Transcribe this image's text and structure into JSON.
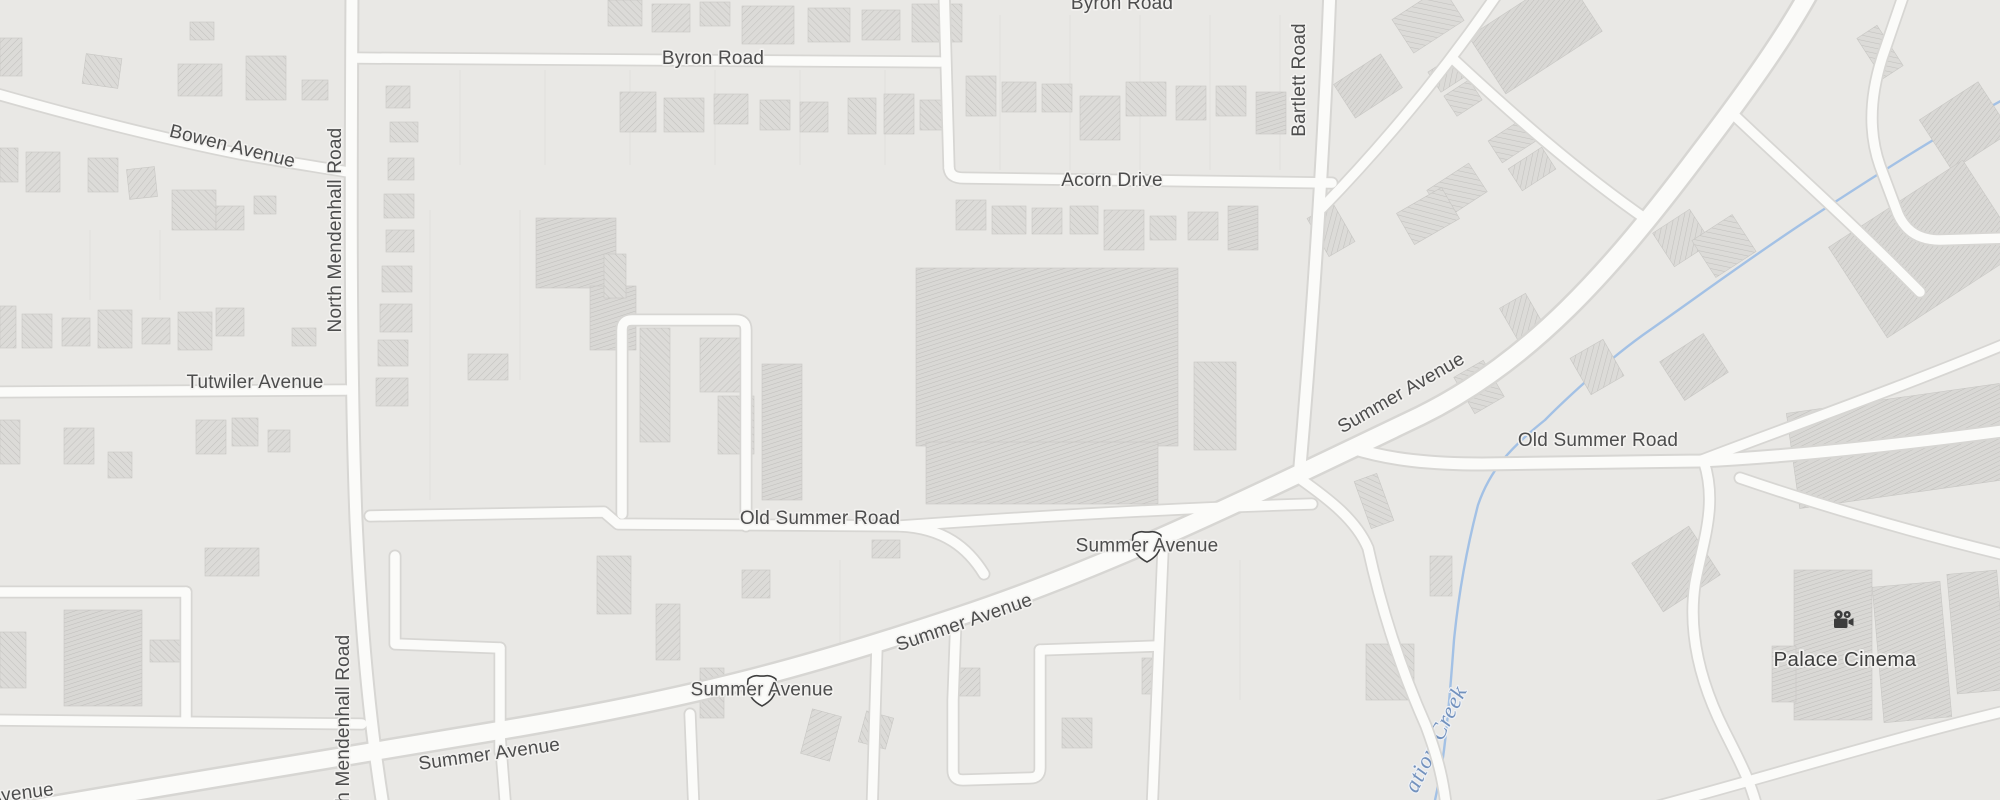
{
  "map": {
    "colors": {
      "background": "#e9e8e5",
      "road_fill": "#fbfbf9",
      "road_casing": "#d7d6d3",
      "building_fill": "#dcdbd8",
      "building_hatch": "#c2c1be",
      "creek": "#a3c1e5",
      "label": "#4d4d4d",
      "creek_label": "#7291bd",
      "poi_label": "#3e3e3e"
    },
    "roads": [
      {
        "id": "summer-avenue",
        "w": "major",
        "d": "M -20 818 C 160 786 330 760 520 727 C 700 696 810 666 960 616 C 1110 566 1240 502 1420 416 C 1530 362 1610 272 1700 152 C 1755 80 1795 22 1820 -28"
      },
      {
        "id": "north-mendenhall-road",
        "w": "mid",
        "d": "M 352 -10 C 351 180 350 360 356 520 C 362 650 372 740 384 812"
      },
      {
        "id": "bowen-avenue",
        "w": "minor",
        "d": "M -10 92 C 60 112 150 136 240 154 C 290 163 326 168 348 172"
      },
      {
        "id": "tutwiler-avenue",
        "w": "minor",
        "d": "M -10 392 L 346 390"
      },
      {
        "id": "byron-road-west",
        "w": "minor",
        "d": "M 354 58 L 940 62"
      },
      {
        "id": "byron-connector",
        "w": "minor",
        "d": "M 944 -12 L 949 168"
      },
      {
        "id": "acorn-drive",
        "w": "minor",
        "d": "M 949 168 C 950 176 956 178 964 178 L 1332 183"
      },
      {
        "id": "bartlett-road",
        "w": "mid",
        "d": "M 1330 -12 C 1324 150 1312 330 1299 478"
      },
      {
        "id": "old-summer-road-west",
        "w": "minor",
        "d": "M 370 516 L 604 512 L 618 524 L 900 526 C 944 528 968 548 984 574"
      },
      {
        "id": "old-summer-road-west-branch",
        "w": "minor",
        "d": "M 900 526 C 1040 516 1180 508 1312 504"
      },
      {
        "id": "mid-loop",
        "w": "minor",
        "d": "M 622 514 L 622 330 Q 622 320 632 320 L 736 320 Q 746 320 746 330 L 746 526"
      },
      {
        "id": "stub-a",
        "w": "minor",
        "d": "M 395 556 L 395 644 L 500 648"
      },
      {
        "id": "stub-b",
        "w": "minor",
        "d": "M 500 648 L 500 752"
      },
      {
        "id": "left-block-north",
        "w": "minor",
        "d": "M -10 592 L 186 592"
      },
      {
        "id": "left-block-east",
        "w": "minor",
        "d": "M 186 592 L 186 720"
      },
      {
        "id": "left-block-south",
        "w": "minor",
        "d": "M -10 720 L 362 724"
      },
      {
        "id": "south-stub-1",
        "w": "minor",
        "d": "M 500 736 L 506 812"
      },
      {
        "id": "south-stub-2",
        "w": "minor",
        "d": "M 690 714 L 694 812"
      },
      {
        "id": "south-road-1",
        "w": "minor",
        "d": "M 877 646 L 872 812"
      },
      {
        "id": "se-loop",
        "w": "minor",
        "d": "M 956 618 L 953 700 L 953 770 Q 953 780 963 780 L 1030 778 Q 1040 778 1040 768 L 1040 650"
      },
      {
        "id": "se-connector",
        "w": "minor",
        "d": "M 1040 650 L 1158 646"
      },
      {
        "id": "south-road-2",
        "w": "minor",
        "d": "M 1163 550 C 1160 620 1157 700 1152 812"
      },
      {
        "id": "creekside-road",
        "w": "minor",
        "d": "M 1299 478 C 1330 500 1356 520 1368 548 C 1382 612 1402 672 1426 726 C 1438 758 1444 782 1447 814"
      },
      {
        "id": "old-summer-road-east",
        "w": "mid",
        "d": "M 1352 448 C 1390 460 1432 464 1482 464 L 1700 461 C 1800 456 1920 442 2010 430"
      },
      {
        "id": "fork-up",
        "w": "minor",
        "d": "M 1702 460 C 1780 430 1900 388 2010 342"
      },
      {
        "id": "cinema-road",
        "w": "minor",
        "d": "M 1704 462 C 1718 506 1702 544 1695 584 C 1688 632 1700 682 1724 730 C 1740 762 1752 784 1758 812"
      },
      {
        "id": "bottom-diagonal",
        "w": "minor",
        "d": "M 1636 812 C 1750 782 1900 736 2010 710"
      },
      {
        "id": "lower-branch",
        "w": "minor",
        "d": "M 1740 478 C 1810 502 1910 532 2010 556"
      },
      {
        "id": "ne-street-1",
        "w": "minor",
        "d": "M 1322 208 C 1380 148 1440 78 1500 -10"
      },
      {
        "id": "ne-street-2",
        "w": "minor",
        "d": "M 1452 58 C 1510 112 1575 170 1650 222"
      },
      {
        "id": "ne-street-3",
        "w": "minor",
        "d": "M 1735 116 C 1792 170 1855 226 1920 292"
      },
      {
        "id": "ne-loop",
        "w": "minor",
        "d": "M 1906 -12 L 1882 58 C 1870 96 1868 132 1880 166 L 1898 214 C 1906 232 1920 240 1940 240 L 2010 238"
      }
    ],
    "buildings": [
      [
        0,
        38,
        22,
        38,
        0,
        0
      ],
      [
        84,
        56,
        36,
        30,
        8,
        1
      ],
      [
        178,
        64,
        44,
        32,
        0,
        0
      ],
      [
        246,
        56,
        40,
        44,
        0,
        1
      ],
      [
        302,
        80,
        26,
        20,
        0,
        0
      ],
      [
        190,
        22,
        24,
        18,
        0,
        1
      ],
      [
        0,
        148,
        18,
        34,
        0,
        1
      ],
      [
        26,
        152,
        34,
        40,
        0,
        0
      ],
      [
        88,
        158,
        30,
        34,
        0,
        1
      ],
      [
        128,
        168,
        28,
        30,
        -6,
        0
      ],
      [
        172,
        190,
        44,
        40,
        0,
        1
      ],
      [
        216,
        206,
        28,
        24,
        0,
        0
      ],
      [
        254,
        196,
        22,
        18,
        0,
        1
      ],
      [
        0,
        306,
        16,
        42,
        0,
        0
      ],
      [
        22,
        314,
        30,
        34,
        0,
        1
      ],
      [
        62,
        318,
        28,
        28,
        0,
        0
      ],
      [
        98,
        310,
        34,
        38,
        0,
        1
      ],
      [
        142,
        318,
        28,
        26,
        0,
        0
      ],
      [
        178,
        312,
        34,
        38,
        0,
        1
      ],
      [
        216,
        308,
        28,
        28,
        0,
        0
      ],
      [
        292,
        328,
        24,
        18,
        0,
        1
      ],
      [
        0,
        420,
        20,
        44,
        0,
        1
      ],
      [
        64,
        428,
        30,
        36,
        0,
        0
      ],
      [
        108,
        452,
        24,
        26,
        0,
        1
      ],
      [
        196,
        420,
        30,
        34,
        0,
        0
      ],
      [
        232,
        418,
        26,
        28,
        0,
        1
      ],
      [
        268,
        430,
        22,
        22,
        0,
        0
      ],
      [
        64,
        610,
        78,
        96,
        0,
        2
      ],
      [
        0,
        632,
        26,
        56,
        0,
        1
      ],
      [
        205,
        548,
        54,
        28,
        0,
        0
      ],
      [
        150,
        640,
        30,
        22,
        0,
        1
      ],
      [
        386,
        86,
        24,
        22,
        0,
        0
      ],
      [
        390,
        122,
        28,
        20,
        0,
        1
      ],
      [
        388,
        158,
        26,
        22,
        0,
        0
      ],
      [
        384,
        194,
        30,
        24,
        0,
        1
      ],
      [
        386,
        230,
        28,
        22,
        0,
        0
      ],
      [
        382,
        266,
        30,
        26,
        0,
        1
      ],
      [
        380,
        304,
        32,
        28,
        0,
        0
      ],
      [
        378,
        340,
        30,
        26,
        0,
        1
      ],
      [
        376,
        378,
        32,
        28,
        0,
        0
      ],
      [
        608,
        0,
        34,
        26,
        0,
        1
      ],
      [
        652,
        4,
        38,
        28,
        0,
        0
      ],
      [
        700,
        2,
        30,
        24,
        0,
        1
      ],
      [
        742,
        6,
        52,
        38,
        0,
        0
      ],
      [
        808,
        8,
        42,
        34,
        0,
        1
      ],
      [
        862,
        10,
        38,
        30,
        0,
        0
      ],
      [
        912,
        4,
        50,
        38,
        0,
        1
      ],
      [
        620,
        92,
        36,
        40,
        0,
        0
      ],
      [
        664,
        98,
        40,
        34,
        0,
        1
      ],
      [
        714,
        94,
        34,
        30,
        0,
        0
      ],
      [
        760,
        100,
        30,
        30,
        0,
        1
      ],
      [
        800,
        102,
        28,
        30,
        0,
        0
      ],
      [
        848,
        98,
        28,
        36,
        0,
        1
      ],
      [
        884,
        94,
        30,
        40,
        0,
        0
      ],
      [
        920,
        100,
        24,
        30,
        0,
        1
      ],
      [
        966,
        76,
        30,
        40,
        0,
        1
      ],
      [
        1002,
        82,
        34,
        30,
        0,
        0
      ],
      [
        1042,
        84,
        30,
        28,
        0,
        1
      ],
      [
        1080,
        96,
        40,
        44,
        0,
        0
      ],
      [
        1126,
        82,
        40,
        34,
        0,
        1
      ],
      [
        1176,
        86,
        30,
        34,
        0,
        0
      ],
      [
        1216,
        86,
        30,
        30,
        0,
        1
      ],
      [
        1256,
        92,
        30,
        42,
        0,
        2
      ],
      [
        956,
        200,
        30,
        30,
        0,
        0
      ],
      [
        992,
        206,
        34,
        28,
        0,
        1
      ],
      [
        1032,
        208,
        30,
        26,
        0,
        0
      ],
      [
        1070,
        206,
        28,
        28,
        0,
        1
      ],
      [
        1104,
        210,
        40,
        40,
        0,
        0
      ],
      [
        1150,
        216,
        26,
        24,
        0,
        1
      ],
      [
        1188,
        212,
        30,
        28,
        0,
        0
      ],
      [
        1228,
        206,
        30,
        44,
        0,
        2
      ],
      [
        536,
        218,
        80,
        70,
        0,
        2
      ],
      [
        590,
        286,
        46,
        64,
        0,
        2
      ],
      [
        640,
        328,
        30,
        114,
        0,
        1
      ],
      [
        700,
        338,
        42,
        54,
        0,
        0
      ],
      [
        718,
        396,
        36,
        58,
        0,
        1
      ],
      [
        468,
        354,
        40,
        26,
        0,
        0
      ],
      [
        604,
        254,
        22,
        44,
        0,
        1
      ],
      [
        916,
        268,
        262,
        178,
        0,
        2
      ],
      [
        926,
        442,
        232,
        62,
        0,
        2
      ],
      [
        1194,
        362,
        42,
        88,
        0,
        1
      ],
      [
        762,
        364,
        40,
        136,
        0,
        2
      ],
      [
        872,
        540,
        28,
        18,
        0,
        0
      ],
      [
        597,
        556,
        34,
        58,
        0,
        1
      ],
      [
        656,
        604,
        24,
        56,
        0,
        0
      ],
      [
        700,
        668,
        24,
        50,
        0,
        1
      ],
      [
        742,
        570,
        28,
        28,
        0,
        0
      ],
      [
        862,
        714,
        28,
        32,
        15,
        1
      ],
      [
        952,
        668,
        28,
        28,
        0,
        0
      ],
      [
        1062,
        718,
        30,
        30,
        0,
        1
      ],
      [
        1142,
        658,
        20,
        36,
        0,
        0
      ],
      [
        1340,
        66,
        56,
        40,
        -33,
        2
      ],
      [
        1398,
        0,
        60,
        40,
        -33,
        1
      ],
      [
        1432,
        62,
        30,
        24,
        -33,
        0
      ],
      [
        1448,
        86,
        30,
        24,
        -33,
        1
      ],
      [
        1478,
        0,
        115,
        68,
        -33,
        2
      ],
      [
        1492,
        128,
        40,
        26,
        -33,
        1
      ],
      [
        1512,
        156,
        40,
        26,
        -33,
        0
      ],
      [
        1432,
        174,
        50,
        34,
        -33,
        1
      ],
      [
        1660,
        218,
        44,
        40,
        -33,
        0
      ],
      [
        1868,
        28,
        24,
        48,
        -33,
        1
      ],
      [
        1930,
        96,
        70,
        60,
        -33,
        2
      ],
      [
        1845,
        195,
        160,
        108,
        -33,
        2
      ],
      [
        1700,
        224,
        48,
        44,
        -33,
        1
      ],
      [
        1316,
        208,
        30,
        44,
        -30,
        0
      ],
      [
        1402,
        198,
        52,
        36,
        -30,
        1
      ],
      [
        1508,
        298,
        30,
        42,
        -30,
        0
      ],
      [
        1462,
        366,
        34,
        42,
        -30,
        1
      ],
      [
        1578,
        346,
        38,
        42,
        -30,
        0
      ],
      [
        1668,
        344,
        52,
        46,
        -33,
        2
      ],
      [
        1792,
        398,
        215,
        96,
        -8,
        2
      ],
      [
        1642,
        540,
        68,
        58,
        -33,
        2
      ],
      [
        1362,
        476,
        24,
        50,
        -20,
        1
      ],
      [
        1430,
        556,
        22,
        40,
        0,
        0
      ],
      [
        1366,
        644,
        48,
        56,
        0,
        1
      ],
      [
        1794,
        570,
        78,
        150,
        0,
        2
      ],
      [
        1772,
        646,
        24,
        56,
        0,
        2
      ],
      [
        1878,
        584,
        68,
        136,
        -5,
        2
      ],
      [
        1952,
        572,
        50,
        120,
        -5,
        2
      ],
      [
        806,
        712,
        30,
        46,
        15,
        0
      ]
    ],
    "parcel_lines": [
      [
        460,
        70,
        165
      ],
      [
        545,
        70,
        165
      ],
      [
        630,
        70,
        165
      ],
      [
        715,
        70,
        165
      ],
      [
        800,
        70,
        165
      ],
      [
        885,
        70,
        165
      ],
      [
        1000,
        15,
        170
      ],
      [
        1070,
        15,
        170
      ],
      [
        1140,
        15,
        170
      ],
      [
        1210,
        15,
        170
      ],
      [
        1280,
        15,
        170
      ],
      [
        430,
        210,
        500
      ],
      [
        520,
        210,
        380
      ],
      [
        840,
        560,
        660
      ],
      [
        1240,
        560,
        700
      ],
      [
        90,
        230,
        300
      ],
      [
        160,
        230,
        300
      ]
    ],
    "labels": [
      {
        "text": "Byron Road",
        "x": 1122,
        "y": 9,
        "rot": 0
      },
      {
        "text": "Byron Road",
        "x": 713,
        "y": 64,
        "rot": 0
      },
      {
        "text": "Bowen Avenue",
        "x": 231,
        "y": 152,
        "rot": 14
      },
      {
        "text": "Acorn Drive",
        "x": 1112,
        "y": 186,
        "rot": 0
      },
      {
        "text": "Bartlett Road",
        "x": 1305,
        "y": 80,
        "rot": -90
      },
      {
        "text": "North Mendenhall Road",
        "x": 341,
        "y": 230,
        "rot": -90
      },
      {
        "text": "Tutwiler Avenue",
        "x": 255,
        "y": 388,
        "rot": 0
      },
      {
        "text": "Old Summer Road",
        "x": 820,
        "y": 524,
        "rot": 0
      },
      {
        "text": "Old Summer Road",
        "x": 1598,
        "y": 446,
        "rot": 0
      },
      {
        "text": "Summer Avenue",
        "x": 1404,
        "y": 398,
        "rot": -30
      },
      {
        "text": "Summer Avenue",
        "x": 966,
        "y": 628,
        "rot": -19
      },
      {
        "text": "Summer Avenue",
        "x": 490,
        "y": 760,
        "rot": -8
      },
      {
        "text": "North Mendenhall Road",
        "x": 349,
        "y": 737,
        "rot": -90
      },
      {
        "text": "Avenue",
        "x": 22,
        "y": 799,
        "rot": -7
      }
    ],
    "shields": [
      {
        "text": "Summer Avenue",
        "x": 1147,
        "y": 545,
        "icon": "us-route-shield-icon"
      },
      {
        "text": "Summer Avenue",
        "x": 762,
        "y": 689,
        "icon": "us-route-shield-icon"
      }
    ],
    "creek": {
      "d": "M 2010 96 C 1950 128 1880 172 1800 225 C 1740 265 1700 295 1650 330 C 1598 366 1545 420 1545 420 C 1510 448 1490 470 1478 505 C 1465 555 1458 600 1454 640 C 1451 680 1449 710 1444 750 C 1440 780 1436 795 1432 814",
      "label": {
        "text": "ation Creek",
        "x": 1442,
        "y": 742,
        "rot": -64
      }
    },
    "poi": {
      "label": "Palace Cinema",
      "icon": "cinema-camera-icon",
      "x": 1843,
      "y": 622,
      "label_y": 666
    }
  }
}
